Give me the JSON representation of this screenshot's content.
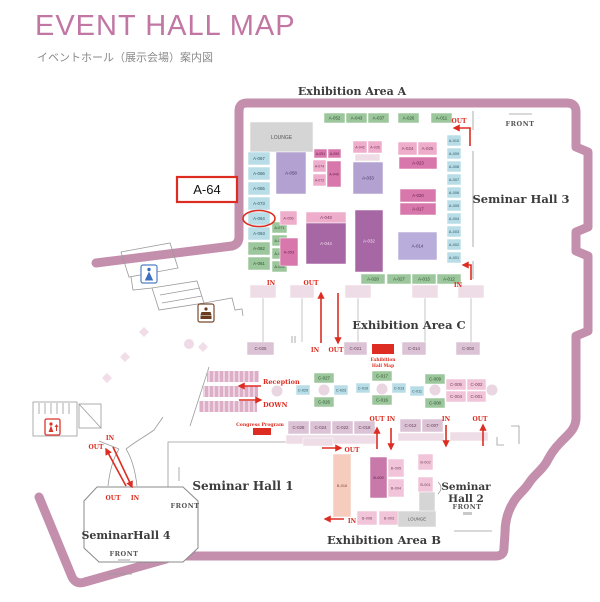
{
  "header": {
    "title": "EVENT HALL MAP",
    "subtitle": "イベントホール（展示会場）案内図"
  },
  "areas": {
    "a": "Exhibition Area A",
    "c": "Exhibition Area C",
    "b": "Exhibition Area B",
    "hall1": "Seminar Hall 1",
    "hall2_line1": "Seminar",
    "hall2_line2": "Hall 2",
    "hall3": "Seminar Hall 3",
    "hall4": "SeminarHall 4"
  },
  "misc": {
    "front": "FRONT",
    "reception": "Reception",
    "down": "DOWN",
    "congress_program": "Congress Program",
    "hall_map_label_1": "Exhibition",
    "hall_map_label_2": "Hall Map",
    "callout": "A-64"
  },
  "colors": {
    "title": "#c176a3",
    "red": "#dd2d22",
    "outline": "#c48fac",
    "palette": {
      "green": {
        "f": "#9cc79c",
        "t": "#2f4e2e"
      },
      "blue": {
        "f": "#b9dde6",
        "t": "#2c5766"
      },
      "mauve": {
        "f": "#dcc2d5",
        "t": "#66405a"
      },
      "lpink": {
        "f": "#f1c4d9",
        "t": "#74455c"
      },
      "pink": {
        "f": "#efadcc",
        "t": "#7b3a5c"
      },
      "dpink": {
        "f": "#d877ac",
        "t": "#651f47"
      },
      "dpink2": {
        "f": "#c978aa",
        "t": "#571e41"
      },
      "dpurple": {
        "f": "#a767a4",
        "t": "#f3e0ee"
      },
      "lpurple": {
        "f": "#b3a2d1",
        "t": "#453463"
      },
      "lpurple2": {
        "f": "#b9addb",
        "t": "#453463"
      },
      "peach": {
        "f": "#f5ccbe",
        "t": "#7d4636"
      },
      "gray": {
        "f": "#d5d5d5",
        "t": "#555555"
      },
      "band": {
        "f": "#eedce6",
        "t": "#999999"
      }
    }
  },
  "map": {
    "booths": [
      {
        "l": "A-052",
        "x": 324,
        "y": 113,
        "w": 21,
        "h": 10,
        "c": "green"
      },
      {
        "l": "A-043",
        "x": 346,
        "y": 113,
        "w": 21,
        "h": 10,
        "c": "green"
      },
      {
        "l": "A-037",
        "x": 368,
        "y": 113,
        "w": 21,
        "h": 10,
        "c": "green"
      },
      {
        "l": "A-026",
        "x": 398,
        "y": 113,
        "w": 21,
        "h": 10,
        "c": "green"
      },
      {
        "l": "A-011",
        "x": 431,
        "y": 113,
        "w": 21,
        "h": 10,
        "c": "green"
      },
      {
        "l": "LOUNGE",
        "x": 250,
        "y": 122,
        "w": 63,
        "h": 30,
        "c": "gray",
        "fs": 5
      },
      {
        "l": "A-067",
        "x": 248,
        "y": 152,
        "w": 22,
        "h": 13,
        "c": "blue"
      },
      {
        "l": "A-066",
        "x": 248,
        "y": 167,
        "w": 22,
        "h": 13,
        "c": "blue"
      },
      {
        "l": "A-065",
        "x": 248,
        "y": 182,
        "w": 22,
        "h": 13,
        "c": "blue"
      },
      {
        "l": "A-073",
        "x": 248,
        "y": 197,
        "w": 22,
        "h": 13,
        "c": "blue"
      },
      {
        "l": "A-064",
        "x": 248,
        "y": 212,
        "w": 22,
        "h": 13,
        "c": "blue"
      },
      {
        "l": "A-063",
        "x": 248,
        "y": 227,
        "w": 22,
        "h": 13,
        "c": "blue"
      },
      {
        "l": "A-062",
        "x": 248,
        "y": 242,
        "w": 22,
        "h": 13,
        "c": "green"
      },
      {
        "l": "A-061",
        "x": 248,
        "y": 257,
        "w": 22,
        "h": 13,
        "c": "green"
      },
      {
        "l": "A-071",
        "x": 272,
        "y": 222,
        "w": 15,
        "h": 11,
        "c": "green",
        "fs": 3.8
      },
      {
        "l": "A-070",
        "x": 272,
        "y": 235,
        "w": 15,
        "h": 11,
        "c": "green",
        "fs": 3.8
      },
      {
        "l": "A-069",
        "x": 272,
        "y": 248,
        "w": 15,
        "h": 11,
        "c": "green",
        "fs": 3.8
      },
      {
        "l": "A-068",
        "x": 272,
        "y": 261,
        "w": 15,
        "h": 11,
        "c": "green",
        "fs": 3.8
      },
      {
        "l": "A-058",
        "x": 276,
        "y": 152,
        "w": 30,
        "h": 42,
        "c": "lpurple"
      },
      {
        "l": "A-051",
        "x": 314,
        "y": 149,
        "w": 13,
        "h": 9,
        "c": "dpink",
        "fs": 3.6
      },
      {
        "l": "A-050",
        "x": 328,
        "y": 149,
        "w": 13,
        "h": 9,
        "c": "dpink",
        "fs": 3.6
      },
      {
        "l": "A-074",
        "x": 313,
        "y": 160,
        "w": 13,
        "h": 12,
        "c": "pink",
        "fs": 3.6
      },
      {
        "l": "A-049",
        "x": 327,
        "y": 161,
        "w": 14,
        "h": 26,
        "c": "dpink",
        "fs": 3.6
      },
      {
        "l": "A-072",
        "x": 313,
        "y": 174,
        "w": 13,
        "h": 12,
        "c": "pink",
        "fs": 3.6
      },
      {
        "l": "A-056",
        "x": 280,
        "y": 211,
        "w": 17,
        "h": 14,
        "c": "pink",
        "fs": 3.8
      },
      {
        "l": "A-053",
        "x": 280,
        "y": 238,
        "w": 18,
        "h": 28,
        "c": "dpink",
        "fs": 3.8
      },
      {
        "l": "A-042",
        "x": 353,
        "y": 141,
        "w": 14,
        "h": 12,
        "c": "pink",
        "fs": 3.6
      },
      {
        "l": "A-036",
        "x": 368,
        "y": 141,
        "w": 14,
        "h": 12,
        "c": "pink",
        "fs": 3.6
      },
      {
        "l": "",
        "x": 355,
        "y": 154,
        "w": 25,
        "h": 7,
        "c": "band"
      },
      {
        "l": "A-033",
        "x": 353,
        "y": 162,
        "w": 30,
        "h": 32,
        "c": "lpurple"
      },
      {
        "l": "A-048",
        "x": 306,
        "y": 212,
        "w": 40,
        "h": 11,
        "c": "pink"
      },
      {
        "l": "A-044",
        "x": 306,
        "y": 223,
        "w": 40,
        "h": 41,
        "c": "dpurple"
      },
      {
        "l": "A-032",
        "x": 355,
        "y": 210,
        "w": 28,
        "h": 62,
        "c": "dpurple"
      },
      {
        "l": "A-024",
        "x": 398,
        "y": 142,
        "w": 19,
        "h": 13,
        "c": "pink"
      },
      {
        "l": "A-025",
        "x": 418,
        "y": 142,
        "w": 19,
        "h": 13,
        "c": "pink"
      },
      {
        "l": "A-023",
        "x": 399,
        "y": 157,
        "w": 38,
        "h": 12,
        "c": "dpink"
      },
      {
        "l": "A-020",
        "x": 400,
        "y": 189,
        "w": 36,
        "h": 13,
        "c": "dpink"
      },
      {
        "l": "A-017",
        "x": 400,
        "y": 203,
        "w": 36,
        "h": 12,
        "c": "dpink"
      },
      {
        "l": "A-014",
        "x": 398,
        "y": 232,
        "w": 39,
        "h": 28,
        "c": "lpurple2"
      },
      {
        "l": "A-010",
        "x": 447,
        "y": 135,
        "w": 14,
        "h": 11,
        "c": "blue",
        "fs": 3.8
      },
      {
        "l": "A-009",
        "x": 447,
        "y": 148,
        "w": 14,
        "h": 11,
        "c": "blue",
        "fs": 3.8
      },
      {
        "l": "A-008",
        "x": 447,
        "y": 161,
        "w": 14,
        "h": 11,
        "c": "blue",
        "fs": 3.8
      },
      {
        "l": "A-007",
        "x": 447,
        "y": 174,
        "w": 14,
        "h": 11,
        "c": "blue",
        "fs": 3.8
      },
      {
        "l": "A-006",
        "x": 447,
        "y": 187,
        "w": 14,
        "h": 11,
        "c": "blue",
        "fs": 3.8
      },
      {
        "l": "A-005",
        "x": 447,
        "y": 200,
        "w": 14,
        "h": 11,
        "c": "blue",
        "fs": 3.8
      },
      {
        "l": "A-004",
        "x": 447,
        "y": 213,
        "w": 14,
        "h": 11,
        "c": "blue",
        "fs": 3.8
      },
      {
        "l": "A-003",
        "x": 447,
        "y": 226,
        "w": 14,
        "h": 11,
        "c": "blue",
        "fs": 3.8
      },
      {
        "l": "A-002",
        "x": 447,
        "y": 239,
        "w": 14,
        "h": 11,
        "c": "blue",
        "fs": 3.8
      },
      {
        "l": "A-001",
        "x": 447,
        "y": 252,
        "w": 14,
        "h": 11,
        "c": "blue",
        "fs": 3.8
      },
      {
        "l": "A-028",
        "x": 361,
        "y": 274,
        "w": 24,
        "h": 10,
        "c": "green"
      },
      {
        "l": "A-027",
        "x": 387,
        "y": 274,
        "w": 24,
        "h": 10,
        "c": "green"
      },
      {
        "l": "A-013",
        "x": 412,
        "y": 274,
        "w": 24,
        "h": 10,
        "c": "green"
      },
      {
        "l": "A-012",
        "x": 437,
        "y": 274,
        "w": 24,
        "h": 10,
        "c": "green"
      },
      {
        "l": "",
        "x": 250,
        "y": 285,
        "w": 26,
        "h": 13,
        "c": "band"
      },
      {
        "l": "",
        "x": 290,
        "y": 285,
        "w": 24,
        "h": 13,
        "c": "band"
      },
      {
        "l": "",
        "x": 345,
        "y": 285,
        "w": 26,
        "h": 13,
        "c": "band"
      },
      {
        "l": "",
        "x": 412,
        "y": 285,
        "w": 26,
        "h": 13,
        "c": "band"
      },
      {
        "l": "",
        "x": 458,
        "y": 285,
        "w": 26,
        "h": 13,
        "c": "band"
      },
      {
        "l": "C-025",
        "x": 247,
        "y": 342,
        "w": 27,
        "h": 13,
        "c": "mauve"
      },
      {
        "l": "C-021",
        "x": 344,
        "y": 342,
        "w": 23,
        "h": 13,
        "c": "mauve"
      },
      {
        "l": "C-014",
        "x": 402,
        "y": 342,
        "w": 24,
        "h": 13,
        "c": "mauve"
      },
      {
        "l": "C-003",
        "x": 456,
        "y": 342,
        "w": 24,
        "h": 13,
        "c": "mauve"
      },
      {
        "l": "C-027",
        "x": 314,
        "y": 373,
        "w": 20,
        "h": 10,
        "c": "green"
      },
      {
        "l": "C-029",
        "x": 296,
        "y": 385,
        "w": 14,
        "h": 10,
        "c": "blue",
        "fs": 3.8
      },
      {
        "l": "C-023",
        "x": 334,
        "y": 385,
        "w": 14,
        "h": 10,
        "c": "blue",
        "fs": 3.8
      },
      {
        "l": "C-026",
        "x": 314,
        "y": 397,
        "w": 20,
        "h": 10,
        "c": "green"
      },
      {
        "l": "C-017",
        "x": 372,
        "y": 371,
        "w": 20,
        "h": 10,
        "c": "green"
      },
      {
        "l": "C-019",
        "x": 356,
        "y": 383,
        "w": 14,
        "h": 10,
        "c": "blue",
        "fs": 3.8
      },
      {
        "l": "C-013",
        "x": 392,
        "y": 383,
        "w": 14,
        "h": 10,
        "c": "blue",
        "fs": 3.8
      },
      {
        "l": "C-016",
        "x": 372,
        "y": 395,
        "w": 20,
        "h": 10,
        "c": "green"
      },
      {
        "l": "C-009",
        "x": 425,
        "y": 374,
        "w": 20,
        "h": 10,
        "c": "green"
      },
      {
        "l": "C-011",
        "x": 410,
        "y": 386,
        "w": 14,
        "h": 10,
        "c": "blue",
        "fs": 3.8
      },
      {
        "l": "C-008",
        "x": 425,
        "y": 398,
        "w": 20,
        "h": 10,
        "c": "green"
      },
      {
        "l": "C-005",
        "x": 446,
        "y": 379,
        "w": 20,
        "h": 11,
        "c": "lpink"
      },
      {
        "l": "C-002",
        "x": 467,
        "y": 379,
        "w": 19,
        "h": 11,
        "c": "lpink"
      },
      {
        "l": "C-004",
        "x": 446,
        "y": 391,
        "w": 20,
        "h": 11,
        "c": "lpink"
      },
      {
        "l": "C-001",
        "x": 467,
        "y": 391,
        "w": 19,
        "h": 11,
        "c": "lpink"
      },
      {
        "l": "C-028",
        "x": 288,
        "y": 421,
        "w": 21,
        "h": 13,
        "c": "mauve"
      },
      {
        "l": "C-024",
        "x": 310,
        "y": 421,
        "w": 21,
        "h": 13,
        "c": "mauve"
      },
      {
        "l": "C-022",
        "x": 332,
        "y": 421,
        "w": 21,
        "h": 13,
        "c": "mauve"
      },
      {
        "l": "C-018",
        "x": 354,
        "y": 421,
        "w": 21,
        "h": 13,
        "c": "mauve"
      },
      {
        "l": "",
        "x": 286,
        "y": 435,
        "w": 90,
        "h": 9,
        "c": "band"
      },
      {
        "l": "C-012",
        "x": 400,
        "y": 419,
        "w": 21,
        "h": 13,
        "c": "mauve"
      },
      {
        "l": "C-007",
        "x": 422,
        "y": 419,
        "w": 21,
        "h": 13,
        "c": "mauve"
      },
      {
        "l": "",
        "x": 398,
        "y": 433,
        "w": 46,
        "h": 8,
        "c": "band"
      },
      {
        "l": "",
        "x": 450,
        "y": 432,
        "w": 38,
        "h": 9,
        "c": "band"
      },
      {
        "l": "",
        "x": 303,
        "y": 438,
        "w": 30,
        "h": 8,
        "c": "band"
      },
      {
        "l": "B-016",
        "x": 333,
        "y": 454,
        "w": 18,
        "h": 63,
        "c": "peach",
        "fs": 3.8
      },
      {
        "l": "B-009",
        "x": 370,
        "y": 457,
        "w": 17,
        "h": 41,
        "c": "dpink2",
        "fs": 3.8
      },
      {
        "l": "B-005",
        "x": 388,
        "y": 459,
        "w": 16,
        "h": 18,
        "c": "lpink",
        "fs": 3.8
      },
      {
        "l": "B-004",
        "x": 388,
        "y": 479,
        "w": 16,
        "h": 18,
        "c": "lpink",
        "fs": 3.8
      },
      {
        "l": "B-002",
        "x": 418,
        "y": 454,
        "w": 15,
        "h": 16,
        "c": "lpink",
        "fs": 3.8
      },
      {
        "l": "B-001",
        "x": 418,
        "y": 477,
        "w": 15,
        "h": 15,
        "c": "lpink",
        "fs": 3.8
      },
      {
        "l": "B-008",
        "x": 357,
        "y": 511,
        "w": 20,
        "h": 14,
        "c": "lpink",
        "fs": 3.8
      },
      {
        "l": "B-003",
        "x": 379,
        "y": 511,
        "w": 20,
        "h": 14,
        "c": "lpink",
        "fs": 3.8
      },
      {
        "l": "",
        "x": 419,
        "y": 492,
        "w": 16,
        "h": 20,
        "c": "gray"
      },
      {
        "l": "LOUNGE",
        "x": 398,
        "y": 511,
        "w": 38,
        "h": 16,
        "c": "gray",
        "fs": 4.3
      }
    ],
    "arrows": [
      {
        "pts": "470,146 470,128 454,128"
      },
      {
        "pts": "471,280 471,265 463,265"
      },
      {
        "pts": "321,343 321,293"
      },
      {
        "pts": "338,293 338,343"
      },
      {
        "pts": "261,386 239,386"
      },
      {
        "pts": "239,400 261,400"
      },
      {
        "pts": "377,449 377,428"
      },
      {
        "pts": "391,428 391,449"
      },
      {
        "pts": "322,448 341,448"
      },
      {
        "pts": "344,519 325,519"
      },
      {
        "pts": "446,425 446,446"
      },
      {
        "pts": "483,446 483,425"
      },
      {
        "pts": "113,447 132,487"
      },
      {
        "pts": "126,486 106,449"
      }
    ],
    "nav_labels": [
      {
        "t": "OUT",
        "x": 459,
        "y": 123
      },
      {
        "t": "IN",
        "x": 458,
        "y": 287
      },
      {
        "t": "IN",
        "x": 271,
        "y": 285
      },
      {
        "t": "OUT",
        "x": 311,
        "y": 285
      },
      {
        "t": "IN",
        "x": 315,
        "y": 352
      },
      {
        "t": "OUT",
        "x": 336,
        "y": 352
      },
      {
        "t": "OUT",
        "x": 377,
        "y": 421
      },
      {
        "t": "IN",
        "x": 391,
        "y": 421
      },
      {
        "t": "OUT",
        "x": 352,
        "y": 452
      },
      {
        "t": "IN",
        "x": 352,
        "y": 523
      },
      {
        "t": "IN",
        "x": 446,
        "y": 421
      },
      {
        "t": "OUT",
        "x": 480,
        "y": 421
      },
      {
        "t": "IN",
        "x": 110,
        "y": 440
      },
      {
        "t": "OUT",
        "x": 96,
        "y": 449
      },
      {
        "t": "OUT",
        "x": 113,
        "y": 500
      },
      {
        "t": "IN",
        "x": 135,
        "y": 500
      }
    ]
  }
}
